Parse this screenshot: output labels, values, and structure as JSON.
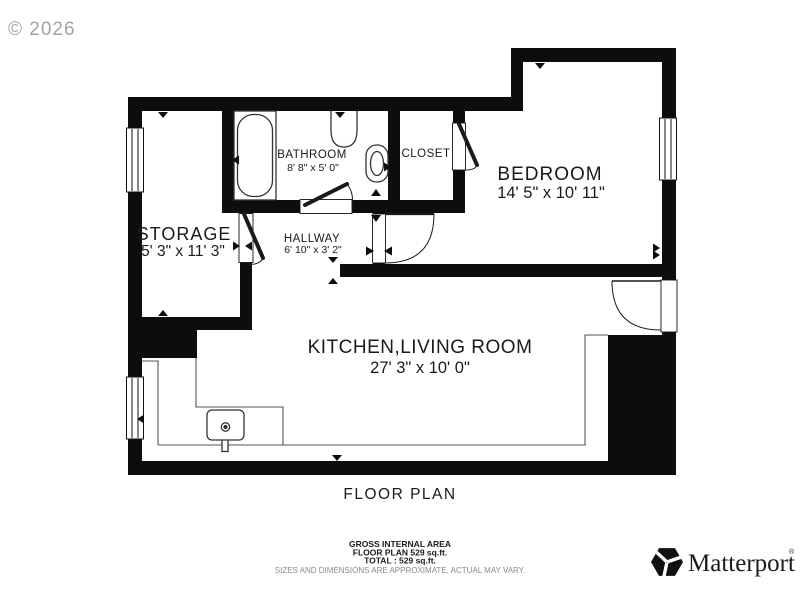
{
  "watermark": {
    "text": "© 2026"
  },
  "rooms": {
    "storage": {
      "name": "STORAGE",
      "dims": "5' 3\" x 11' 3\""
    },
    "bathroom": {
      "name": "BATHROOM",
      "dims": "8' 8\" x 5' 0\""
    },
    "closet": {
      "name": "CLOSET"
    },
    "hallway": {
      "name": "HALLWAY",
      "dims": "6' 10\" x 3' 2\""
    },
    "bedroom": {
      "name": "BEDROOM",
      "dims": "14' 5\" x 10' 11\""
    },
    "kitchen_living": {
      "name": "KITCHEN,LIVING ROOM",
      "dims": "27' 3\" x 10' 0\""
    }
  },
  "footer": {
    "plan_title": "FLOOR PLAN",
    "area_heading": "GROSS INTERNAL AREA",
    "area_line1": "FLOOR PLAN 529 sq.ft.",
    "area_line2": "TOTAL :  529 sq.ft.",
    "disclaimer": "SIZES AND DIMENSIONS ARE APPROXIMATE, ACTUAL MAY VARY."
  },
  "brand": {
    "name": "Matterport",
    "registered": "®"
  },
  "colors": {
    "wall": "#0d0d0d",
    "text": "#1a1a1a",
    "muted": "#8a8a8a",
    "watermark": "#a3a3a3"
  }
}
